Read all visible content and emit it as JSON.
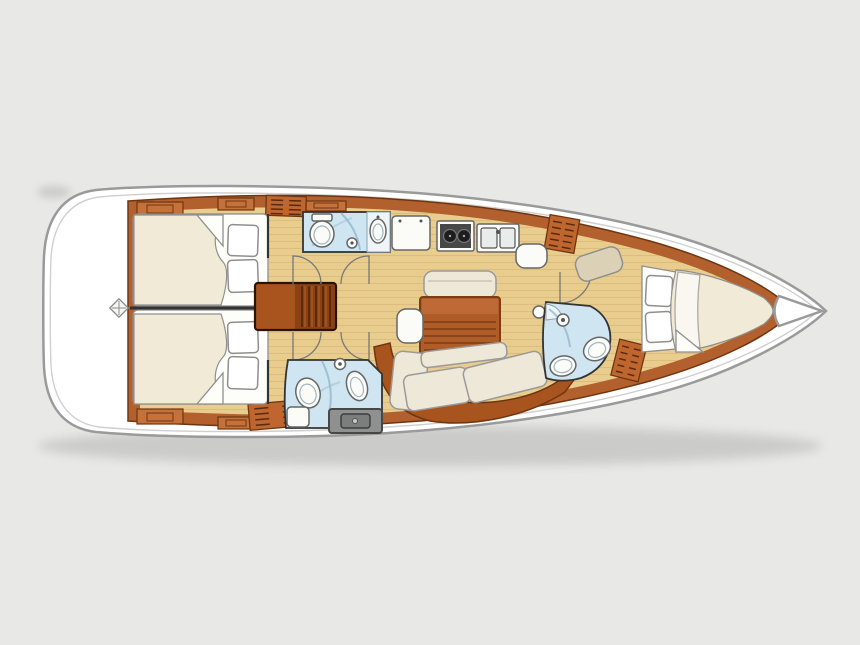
{
  "image": {
    "width": 860,
    "height": 645,
    "description": "Top-down interior layout plan of a sailing yacht hull, bow pointing right: two aft double cabins with a companionway stair between them, two mid-ship heads with toilet, shower and basin, a linear galley with two-burner stove and double sink, a salon with folding table, bench and L-shaped sofa, a navigation seat, a forward head with shower, and a forward V-berth cabin ending at the anchor locker in the bow."
  },
  "palette": {
    "background": "#e8e8e6",
    "hull_fill": "#ffffff",
    "hull_stroke": "#9a9a9a",
    "rim": "#cfcfcf",
    "wood": "#b2602d",
    "wood_dark": "#6f3511",
    "wood_light": "#c4723a",
    "sofa_wood": "#a8541f",
    "louver": "#bf662f",
    "louver_slat": "#5a2a10",
    "floor": "#e8cd8f",
    "plank": "#c89c55",
    "wall": "#333333",
    "outline": "#8f8f8f",
    "bed": "#f1ead6",
    "linen": "#fdfdfa",
    "pillow": "#ffffff",
    "bath": "#cfe5f1",
    "bath_line": "#93b8cc",
    "fixture": "#fbfbf8",
    "fixture_stroke": "#666666",
    "stove": "#474747",
    "burner": "#1d1d1d",
    "table": "#b05c28",
    "table_line": "#7e3c12",
    "table_top": "#bd6a36",
    "cushion": "#eee8d8",
    "cushion_stroke": "#9a9a9a",
    "seat": "#dbd1b6",
    "engine": "#8f9191",
    "engine_dark": "#474747",
    "arc": "#777777",
    "shadow": "rgba(0,0,0,0.12)"
  },
  "boat": {
    "orientation": {
      "bow": "right",
      "stern": "left"
    },
    "rooms": [
      {
        "id": "stern-deck",
        "label": "stern deck with deck-hatch symbol"
      },
      {
        "id": "aft-cabin-top",
        "label": "aft double cabin (top)"
      },
      {
        "id": "aft-cabin-bottom",
        "label": "aft double cabin (bottom)"
      },
      {
        "id": "companionway-steps",
        "label": "companionway steps"
      },
      {
        "id": "head-top",
        "label": "head with toilet, shower and basin (top)"
      },
      {
        "id": "head-bottom",
        "label": "head with toilet and basin (bottom)"
      },
      {
        "id": "galley",
        "label": "galley"
      },
      {
        "id": "salon",
        "label": "salon"
      },
      {
        "id": "nav-seat",
        "label": "navigation seat"
      },
      {
        "id": "forward-head",
        "label": "forward head with shower"
      },
      {
        "id": "forward-cabin",
        "label": "forward V-berth cabin"
      },
      {
        "id": "bow-locker",
        "label": "bow anchor locker"
      }
    ],
    "counts": {
      "double_berths": 3,
      "heads": 3,
      "aft_berth_pillows": 4,
      "stove_burners": 2,
      "galley_sink_basins": 2,
      "louvered_lockers": 4,
      "door_swings": 5
    }
  }
}
